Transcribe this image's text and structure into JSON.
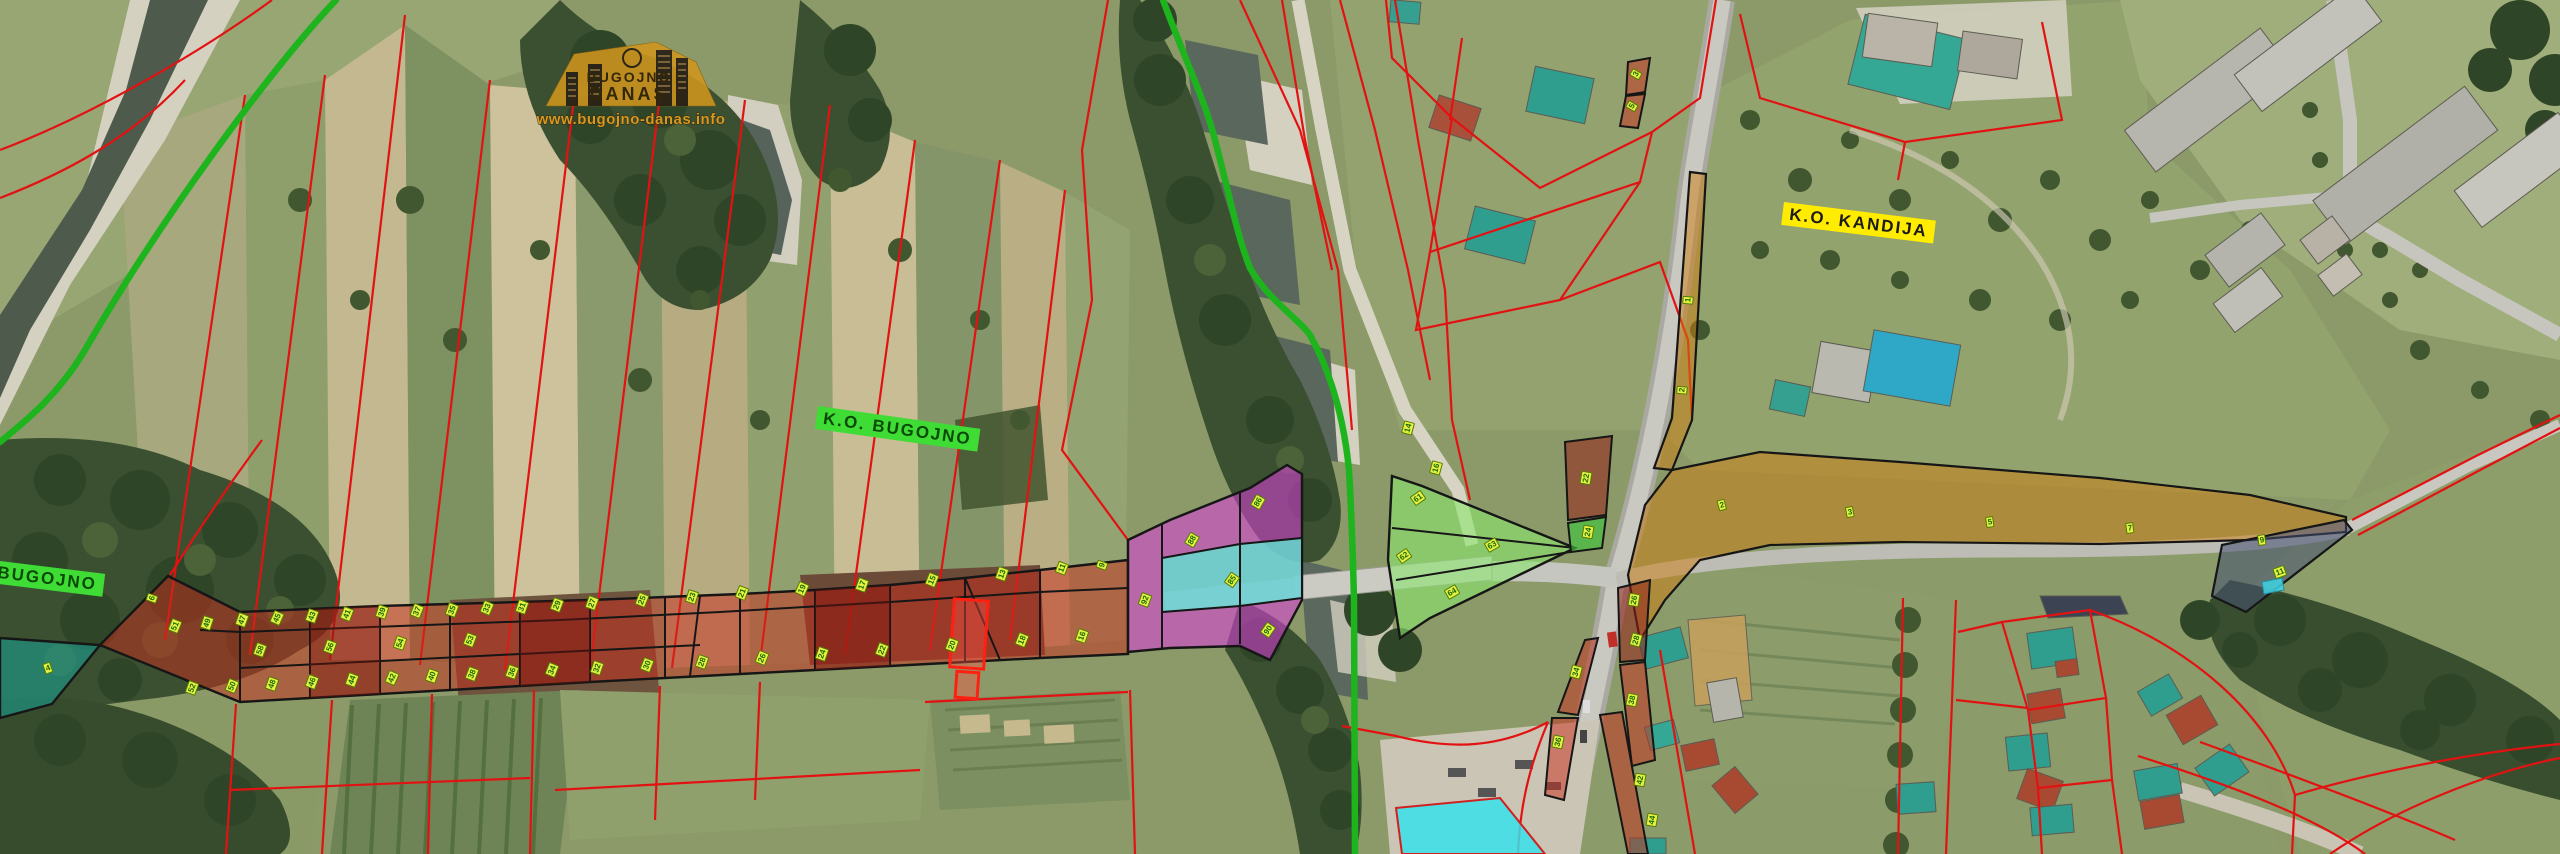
{
  "map": {
    "type": "aerial-cadastral-overlay",
    "place_labels": {
      "ko_bugojno": "K.O.  BUGOJNO",
      "ko_kandija": "K.O.  KANDIJA",
      "bugojno": "BUGOJNO"
    },
    "watermark": {
      "line1": "BUGOJNO",
      "line2": "DANAS",
      "url": "www.bugojno-danas.info"
    },
    "colors": {
      "cadastral_line_red": "#e31212",
      "district_boundary_green": "#1db41d",
      "zone_corridor_red": "#ca2c1c",
      "zone_magenta": "#de3ede",
      "zone_cyan": "#60e8d2",
      "zone_light_green": "#8ce66e",
      "zone_orange": "#cd7d0f",
      "zone_blue_gray": "#465073",
      "zone_teal": "#1b9c8f",
      "parcel_tag_bg": "#e8f046",
      "parcel_tag_text": "#136b00",
      "label_green_bg": "#3fdc35",
      "label_yellow_bg": "#ffec00",
      "watermark_orange": "#d0961e"
    },
    "parcel_markers": [
      [
        175,
        626,
        -68,
        "51"
      ],
      [
        207,
        623,
        -72,
        "49"
      ],
      [
        242,
        620,
        -70,
        "47"
      ],
      [
        277,
        618,
        -66,
        "45"
      ],
      [
        312,
        616,
        -71,
        "43"
      ],
      [
        347,
        614,
        -69,
        "41"
      ],
      [
        382,
        612,
        -72,
        "39"
      ],
      [
        417,
        611,
        -68,
        "37"
      ],
      [
        452,
        610,
        -70,
        "35"
      ],
      [
        487,
        608,
        -67,
        "33"
      ],
      [
        522,
        607,
        -71,
        "31"
      ],
      [
        557,
        605,
        -69,
        "29"
      ],
      [
        592,
        603,
        -70,
        "27"
      ],
      [
        642,
        600,
        -68,
        "25"
      ],
      [
        692,
        597,
        -72,
        "23"
      ],
      [
        742,
        593,
        -69,
        "21"
      ],
      [
        802,
        589,
        -66,
        "19"
      ],
      [
        862,
        585,
        -70,
        "17"
      ],
      [
        932,
        580,
        -68,
        "15"
      ],
      [
        1002,
        574,
        -71,
        "13"
      ],
      [
        1062,
        568,
        -69,
        "11"
      ],
      [
        1102,
        565,
        -70,
        "9"
      ],
      [
        192,
        688,
        -70,
        "52"
      ],
      [
        232,
        686,
        -68,
        "50"
      ],
      [
        272,
        684,
        -71,
        "48"
      ],
      [
        312,
        682,
        -69,
        "46"
      ],
      [
        352,
        680,
        -70,
        "44"
      ],
      [
        392,
        678,
        -67,
        "42"
      ],
      [
        432,
        676,
        -71,
        "40"
      ],
      [
        472,
        674,
        -69,
        "38"
      ],
      [
        512,
        672,
        -70,
        "36"
      ],
      [
        552,
        670,
        -68,
        "34"
      ],
      [
        597,
        668,
        -71,
        "32"
      ],
      [
        647,
        665,
        -69,
        "30"
      ],
      [
        702,
        662,
        -70,
        "28"
      ],
      [
        762,
        658,
        -68,
        "26"
      ],
      [
        822,
        654,
        -71,
        "24"
      ],
      [
        882,
        650,
        -69,
        "22"
      ],
      [
        952,
        645,
        -70,
        "20"
      ],
      [
        1022,
        640,
        -68,
        "18"
      ],
      [
        1082,
        636,
        -71,
        "16"
      ],
      [
        260,
        650,
        -70,
        "58"
      ],
      [
        330,
        647,
        -70,
        "56"
      ],
      [
        400,
        643,
        -71,
        "54"
      ],
      [
        470,
        640,
        -69,
        "53"
      ],
      [
        48,
        668,
        -20,
        "4"
      ],
      [
        152,
        598,
        -70,
        "6"
      ],
      [
        1192,
        540,
        -60,
        "88"
      ],
      [
        1258,
        502,
        -60,
        "86"
      ],
      [
        1268,
        630,
        -55,
        "90"
      ],
      [
        1145,
        600,
        -70,
        "92"
      ],
      [
        1232,
        580,
        -55,
        "85"
      ],
      [
        1418,
        498,
        -35,
        "61"
      ],
      [
        1492,
        545,
        -30,
        "63"
      ],
      [
        1452,
        592,
        -30,
        "64"
      ],
      [
        1404,
        556,
        -35,
        "62"
      ],
      [
        1722,
        505,
        -15,
        "2"
      ],
      [
        1850,
        512,
        -10,
        "3"
      ],
      [
        1990,
        522,
        -8,
        "5"
      ],
      [
        2130,
        528,
        -8,
        "7"
      ],
      [
        2262,
        540,
        -8,
        "9"
      ],
      [
        1688,
        300,
        -85,
        "1"
      ],
      [
        1682,
        390,
        -85,
        "2"
      ],
      [
        2280,
        572,
        -20,
        "11"
      ],
      [
        1408,
        428,
        -75,
        "14"
      ],
      [
        1436,
        468,
        -75,
        "16"
      ],
      [
        1586,
        478,
        -80,
        "22"
      ],
      [
        1588,
        532,
        -80,
        "24"
      ],
      [
        1634,
        600,
        -80,
        "26"
      ],
      [
        1636,
        640,
        -75,
        "28"
      ],
      [
        1576,
        672,
        -75,
        "34"
      ],
      [
        1558,
        742,
        -78,
        "36"
      ],
      [
        1632,
        700,
        -78,
        "38"
      ],
      [
        1640,
        780,
        -80,
        "42"
      ],
      [
        1652,
        820,
        -80,
        "44"
      ],
      [
        1636,
        74,
        -60,
        "3"
      ],
      [
        1632,
        106,
        -60,
        "5"
      ]
    ]
  }
}
